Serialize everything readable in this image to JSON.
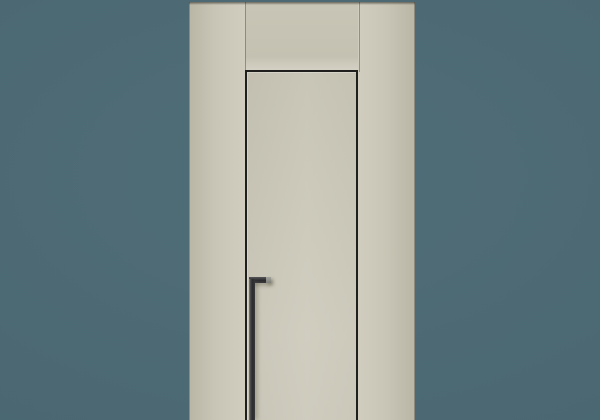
{
  "scene": {
    "type": "product-render",
    "subject": "Minimalist flush interior door with concealed frame",
    "setting": "Flush beige wall paneling centered on a slate-teal studio backdrop",
    "objects": {
      "backdrop": "plain slate-teal background",
      "wall_panel_left": "tall beige panel left of door",
      "wall_panel_right": "tall beige panel right of door",
      "transom_panel": "beige panel above door between two vertical seams",
      "door_slab": "frameless beige door slab outlined by thin dark reveal gap on top, left and right; bottom cropped by image edge",
      "handle": "long matte-black vertical pull handle with short horizontal top arm fixed to the door near the left reveal"
    }
  },
  "theme": {
    "backdrop": "#4c6973",
    "wall-base": "#c9c5b6",
    "wall-light": "#d0cdbf",
    "wall-dark": "#bab6a6",
    "door-base": "#cbc8b9",
    "reveal-line": "#1f1f1d",
    "handle-dark": "#2b2b2e",
    "handle-light": "#a3a39d"
  }
}
